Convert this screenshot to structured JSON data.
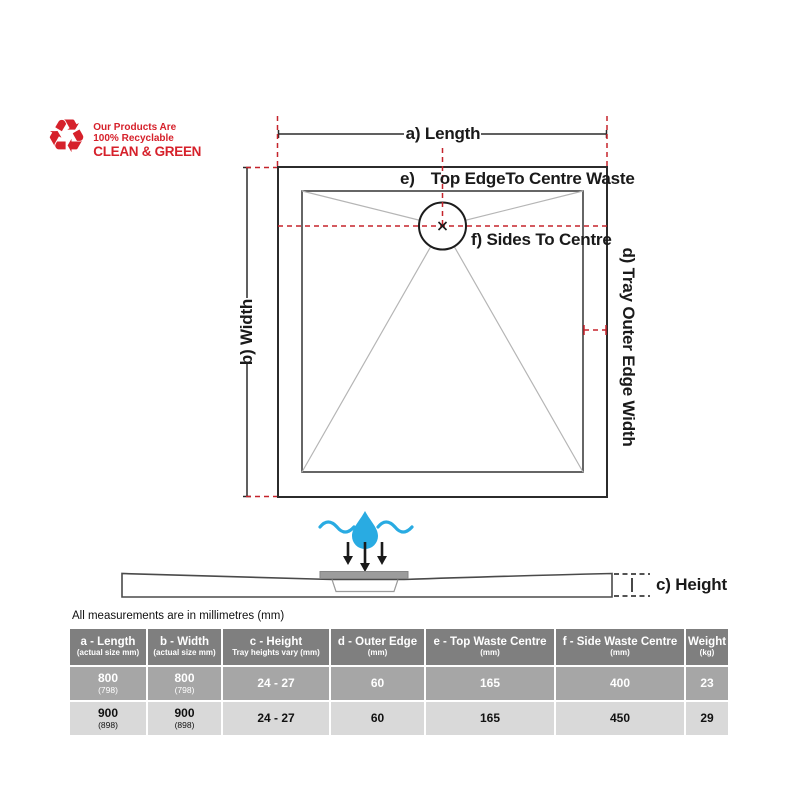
{
  "recycle": {
    "line1": "Our Products Are",
    "line2": "100% Recyclable",
    "line3": "CLEAN & GREEN",
    "icon": "recycle-icon"
  },
  "diagram": {
    "length_label": "a) Length",
    "width_label": "b) Width",
    "top_waste_prefix": "e)",
    "top_waste_label": "Top EdgeTo Centre Waste",
    "sides_label": "f) Sides To Centre",
    "outer_edge_label": "d) Tray Outer Edge Width",
    "height_label": "c) Height"
  },
  "note": "All measurements are in millimetres (mm)",
  "table": {
    "headers": [
      {
        "main": "a - Length",
        "sub": "(actual size mm)"
      },
      {
        "main": "b - Width",
        "sub": "(actual size mm)"
      },
      {
        "main": "c - Height",
        "sub": "Tray heights vary (mm)"
      },
      {
        "main": "d - Outer Edge",
        "sub": "(mm)"
      },
      {
        "main": "e - Top Waste Centre",
        "sub": "(mm)"
      },
      {
        "main": "f - Side Waste Centre",
        "sub": "(mm)"
      },
      {
        "main": "Weight",
        "sub": "(kg)"
      }
    ],
    "rows": [
      {
        "cells": [
          {
            "main": "800",
            "sub": "(798)"
          },
          {
            "main": "800",
            "sub": "(798)"
          },
          {
            "main": "24 - 27",
            "sub": ""
          },
          {
            "main": "60",
            "sub": ""
          },
          {
            "main": "165",
            "sub": ""
          },
          {
            "main": "400",
            "sub": ""
          },
          {
            "main": "23",
            "sub": ""
          }
        ]
      },
      {
        "cells": [
          {
            "main": "900",
            "sub": "(898)"
          },
          {
            "main": "900",
            "sub": "(898)"
          },
          {
            "main": "24 - 27",
            "sub": ""
          },
          {
            "main": "60",
            "sub": ""
          },
          {
            "main": "165",
            "sub": ""
          },
          {
            "main": "450",
            "sub": ""
          },
          {
            "main": "29",
            "sub": ""
          }
        ]
      }
    ]
  },
  "colors": {
    "accent_red": "#c5232b",
    "water_blue": "#29abe2",
    "table_header": "#7f7f7f",
    "table_row_highlight": "#a6a6a6",
    "table_row": "#d9d9d9"
  }
}
